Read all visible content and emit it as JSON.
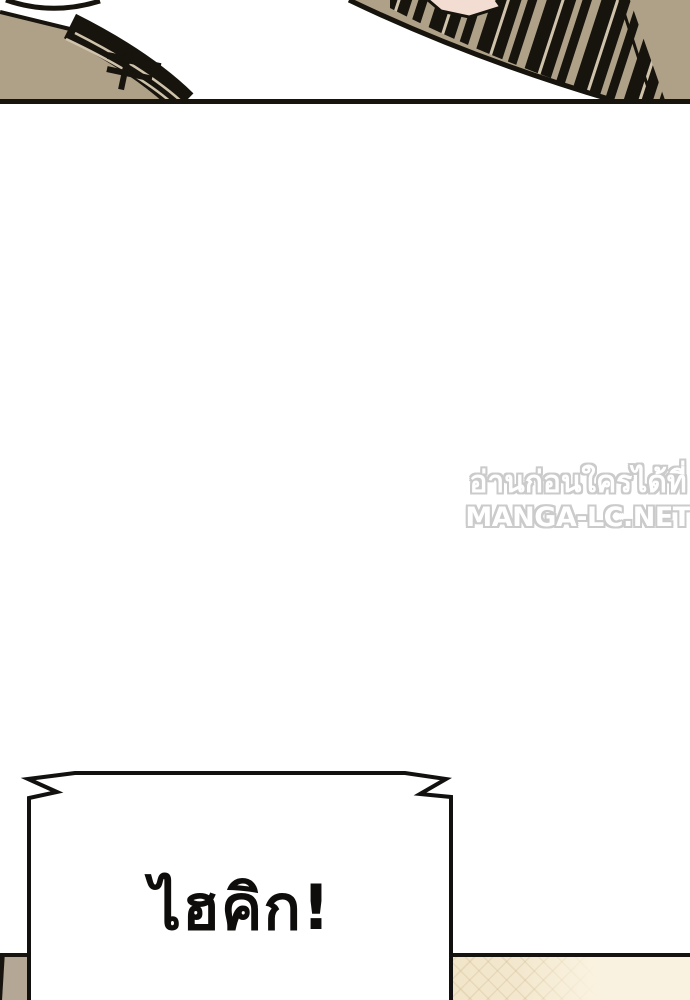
{
  "watermark": {
    "line1": "อ่านก่อนใครได้ที่",
    "line2": "MANGA-LC.NET",
    "fill_color": "#ffffff",
    "outline_color": "#c7c7c7"
  },
  "speech_bubble": {
    "text": "ไฮคิก!",
    "fill": "#ffffff",
    "stroke": "#121110"
  },
  "colors": {
    "panel_tan": "#aea188",
    "panel_ink": "#17130d",
    "stripe_light": "#cfc3ab",
    "skin_pink": "#f3ddd2",
    "bottom_left_tan": "#b5a795",
    "bottom_right_cream": "#f5eacf",
    "page_background": "#ffffff"
  }
}
